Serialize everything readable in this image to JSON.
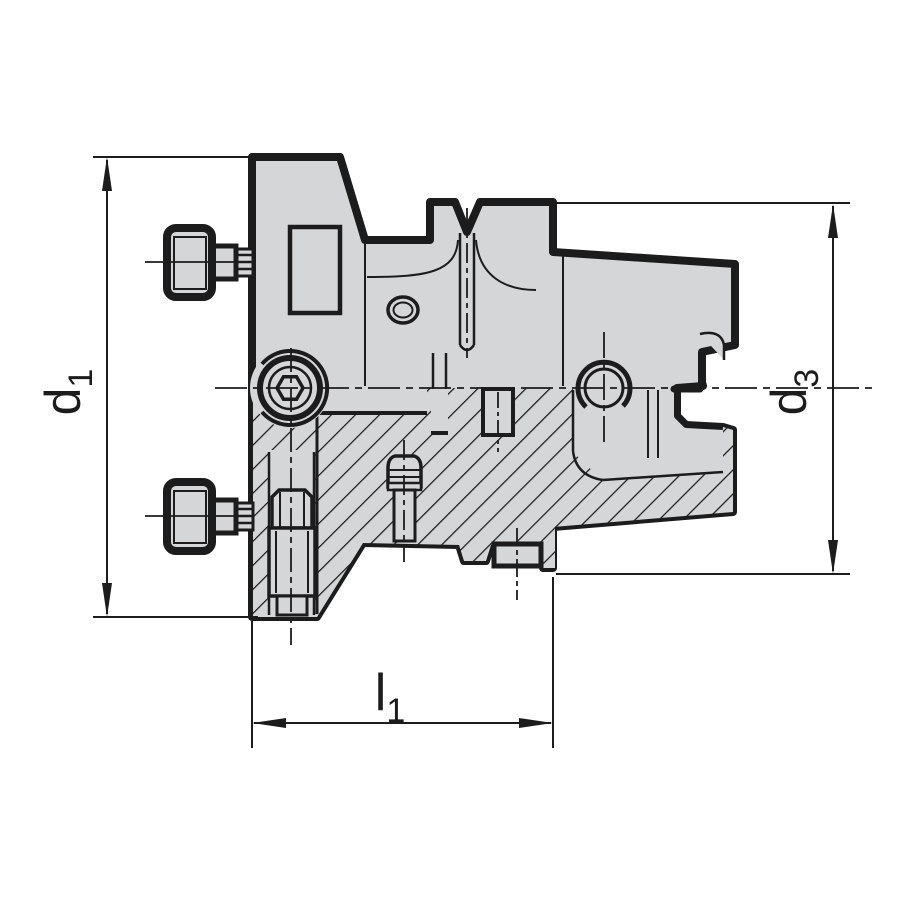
{
  "drawing": {
    "description": "Technical cross-section drawing of a shell mill tool holder with hollow taper shank, side screws and dimension callouts",
    "colors": {
      "outline": "#1c1c1c",
      "body_fill": "#d4d6d8",
      "background": "#ffffff"
    },
    "dimensions": {
      "d1": {
        "base": "d",
        "sub": "1"
      },
      "d3": {
        "base": "d",
        "sub": "3"
      },
      "l1": {
        "base": "l",
        "sub": "1"
      }
    }
  }
}
